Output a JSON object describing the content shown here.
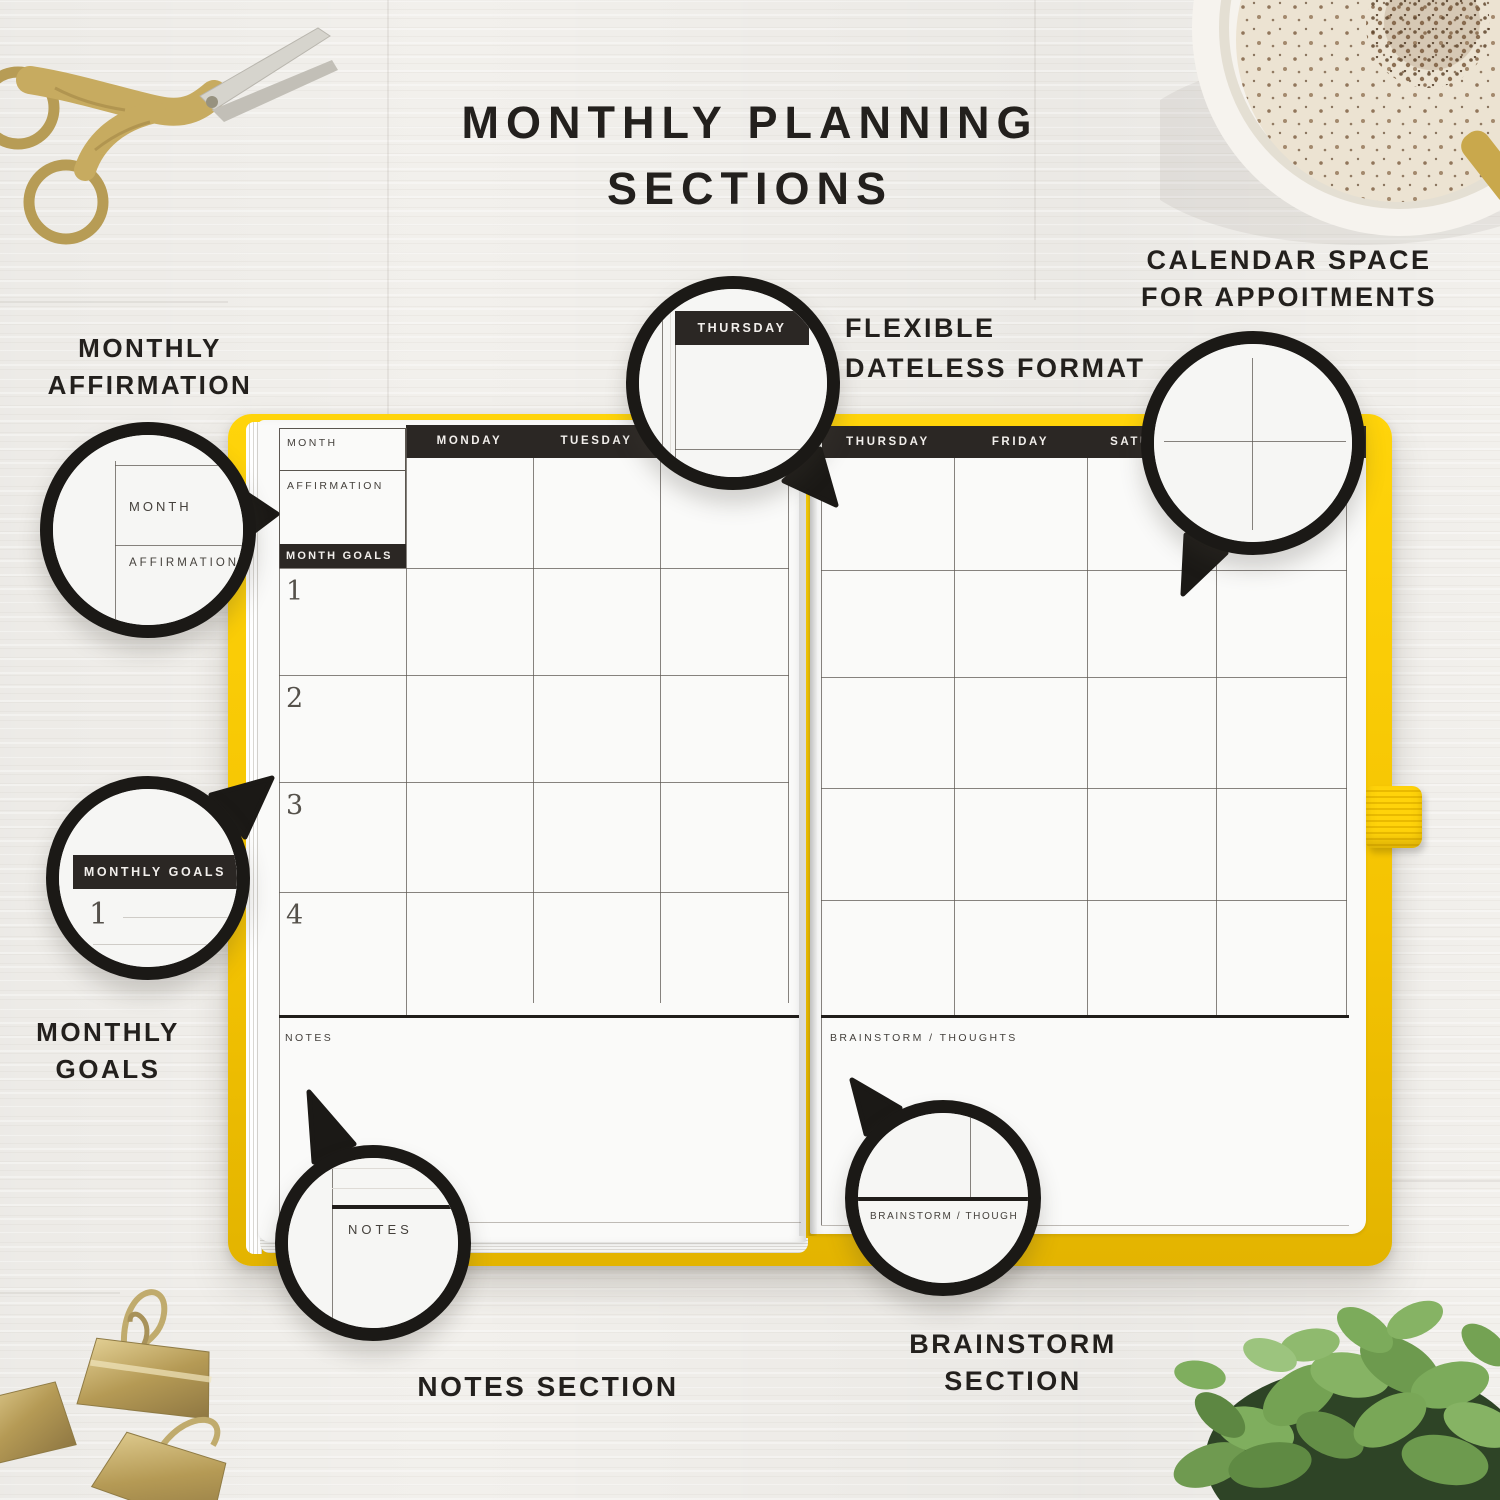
{
  "page": {
    "title_line1": "MONTHLY PLANNING",
    "title_line2": "SECTIONS"
  },
  "labels": {
    "affirmation_line1": "MONTHLY",
    "affirmation_line2": "AFFIRMATION",
    "goals_line1": "MONTHLY",
    "goals_line2": "GOALS",
    "flexible_line1": "FLEXIBLE",
    "flexible_line2": "DATELESS FORMAT",
    "calendar_line1": "CALENDAR SPACE",
    "calendar_line2": "FOR APPOITMENTS",
    "notes": "NOTES SECTION",
    "brainstorm_line1": "BRAINSTORM",
    "brainstorm_line2": "SECTION"
  },
  "planner": {
    "left": {
      "month": "MONTH",
      "affirmation": "AFFIRMATION",
      "month_goals": "MONTH GOALS",
      "goals": [
        "1",
        "2",
        "3",
        "4"
      ],
      "days": [
        "MONDAY",
        "TUESDAY",
        ""
      ],
      "notes": "NOTES"
    },
    "right": {
      "days": [
        "THURSDAY",
        "FRIDAY",
        "SATURDAY",
        ""
      ],
      "brainstorm": "BRAINSTORM / THOUGHTS"
    }
  },
  "magnifiers": {
    "affirmation": {
      "month": "MONTH",
      "affirmation": "AFFIRMATION"
    },
    "goals": {
      "header": "MONTHLY GOALS",
      "number": "1"
    },
    "thursday": {
      "header": "THURSDAY"
    },
    "notes": {
      "label": "NOTES"
    },
    "brainstorm": {
      "label": "BRAINSTORM / THOUGH"
    }
  },
  "colors": {
    "cover_yellow": "#FFD106",
    "bar_dark": "#2B2724",
    "ring_black": "#1B1916"
  }
}
